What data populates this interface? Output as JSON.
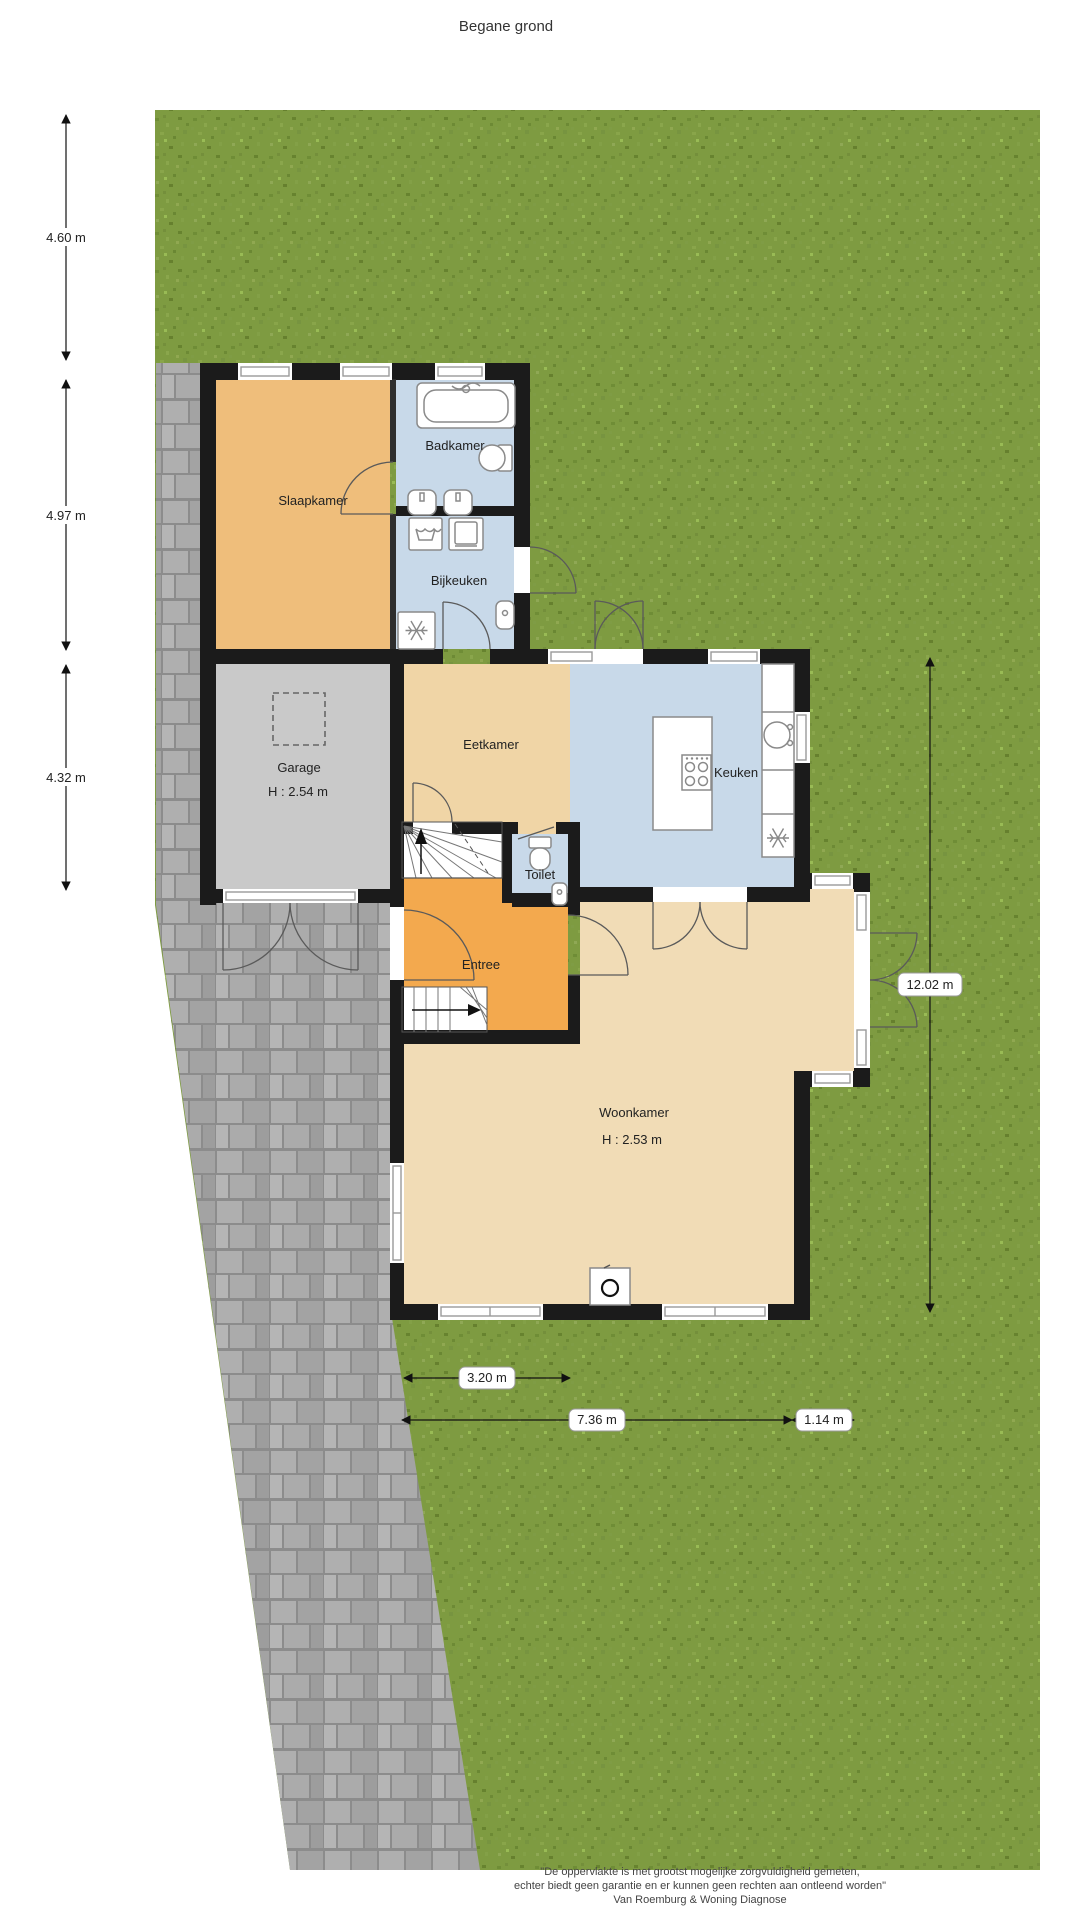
{
  "title": "Begane grond",
  "rooms": {
    "slaapkamer": {
      "label": "Slaapkamer"
    },
    "badkamer": {
      "label": "Badkamer"
    },
    "bijkeuken": {
      "label": "Bijkeuken"
    },
    "garage": {
      "label": "Garage",
      "height": "H : 2.54 m"
    },
    "eetkamer": {
      "label": "Eetkamer"
    },
    "keuken": {
      "label": "Keuken"
    },
    "toilet": {
      "label": "Toilet"
    },
    "entree": {
      "label": "Entree"
    },
    "woonkamer": {
      "label": "Woonkamer",
      "height": "H : 2.53 m"
    }
  },
  "dimensions": {
    "left": [
      "4.60 m",
      "4.97 m",
      "4.32 m"
    ],
    "right": "12.02 m",
    "bottom": [
      "3.20 m",
      "7.36 m",
      "1.14 m"
    ]
  },
  "footer": {
    "line1": "\"De oppervlakte is met grootst mogelijke zorgvuldigheid gemeten,",
    "line2": "echter biedt geen garantie en er kunnen geen rechten aan ontleend worden\"",
    "line3": "Van Roemburg & Woning Diagnose"
  },
  "colors": {
    "grass": "#7E9B41",
    "paving": "#9B9B9B",
    "wall": "#1B1B1B",
    "room_orange": "#EFBE7B",
    "room_tan": "#F1DCB6",
    "room_tan_dark": "#F0D5A6",
    "room_blue": "#C8D9E9",
    "garage_gray": "#C9C9C9"
  }
}
